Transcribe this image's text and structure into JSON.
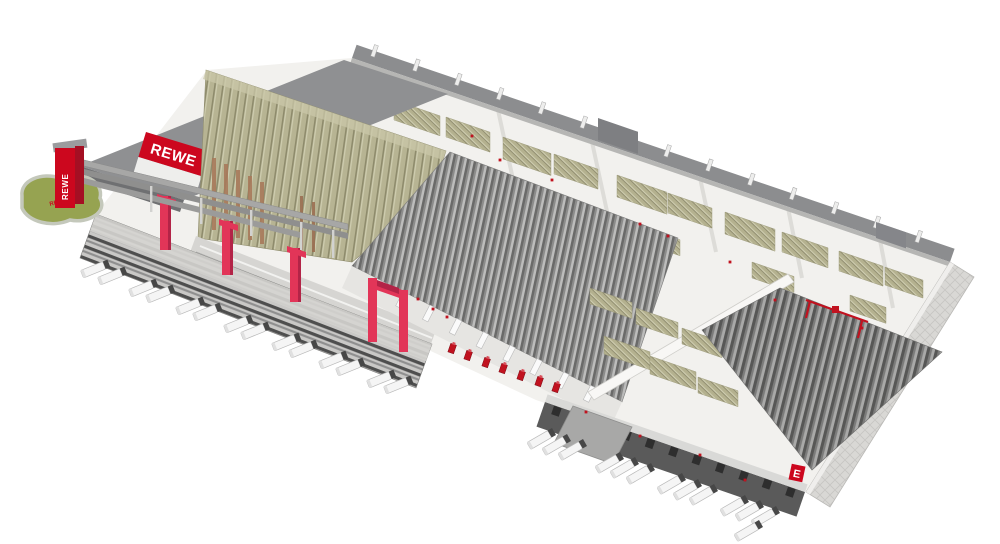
{
  "branding": {
    "logo_text": "REWE",
    "pylon_text": "REWE",
    "grass_text": "REWE",
    "wall_badge_text": "E"
  },
  "colors": {
    "rewe_red": "#cc071e",
    "accent_pink": "#e23558",
    "machine_red": "#c1121f",
    "khaki": "#b7b493",
    "building_gray": "#8c8d8f",
    "grass_green": "#96a351",
    "background": "#ffffff"
  }
}
